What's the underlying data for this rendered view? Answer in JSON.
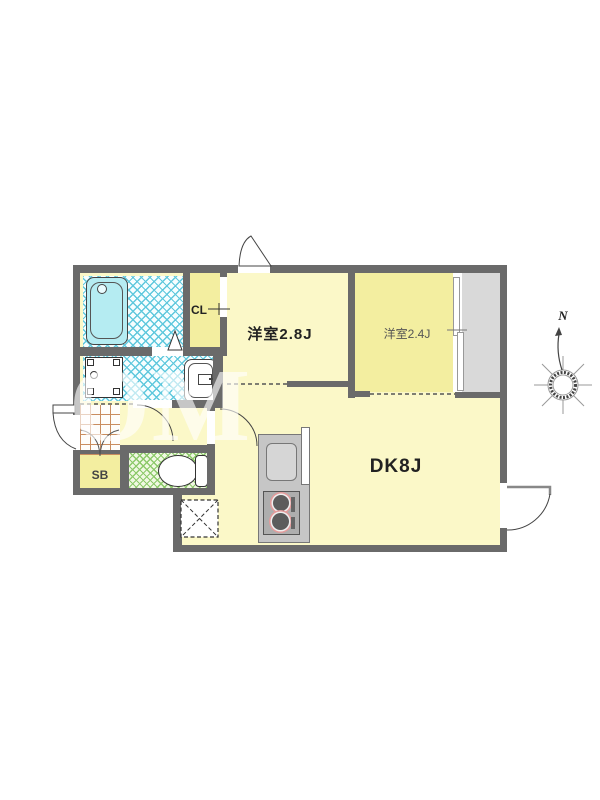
{
  "floorplan": {
    "rooms": {
      "west_room_2_8": {
        "label": "洋室2.8J"
      },
      "west_room_2_4": {
        "label": "洋室2.4J"
      },
      "dk": {
        "label": "DK8J"
      },
      "closet": {
        "label": "CL"
      },
      "shoe_box": {
        "label": "SB"
      }
    },
    "compass": {
      "north_label": "N"
    },
    "watermark_text": "OM CORI",
    "colors": {
      "wall": "#6a6a6a",
      "floor-pale": "#fbf8c8",
      "floor-deep": "#f3eea0",
      "bath-tub": "#b5ecf2",
      "storage-gray": "#d9d9d9",
      "counter-gray": "#c6c6c6",
      "stove-gray": "#aeaeae",
      "burner-ring": "#e49b9b",
      "tile-line": "#c98d5f",
      "wet-line": "#5fc8dd",
      "toilet-line": "#8cc96a"
    }
  }
}
